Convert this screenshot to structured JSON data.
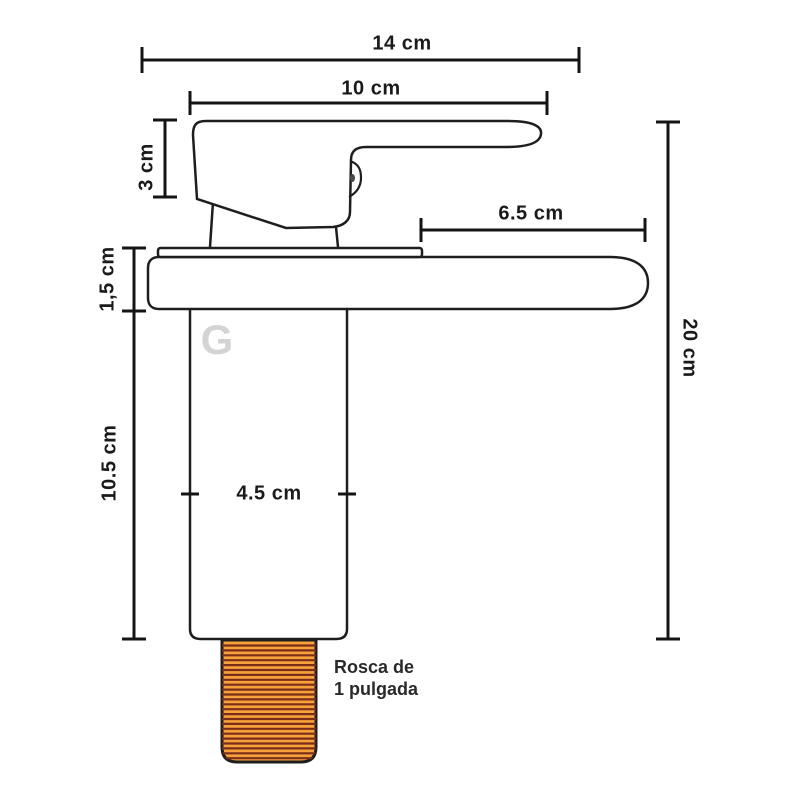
{
  "diagram": {
    "type": "technical-dimension-drawing",
    "subject": "basin faucet side view",
    "dimensions": {
      "overall_width": "14 cm",
      "handle_length": "10 cm",
      "handle_height": "3 cm",
      "spout_reach": "6.5 cm",
      "deck_thickness": "1,5 cm",
      "body_height": "10.5 cm",
      "body_width": "4.5 cm",
      "overall_height": "20 cm"
    },
    "note": {
      "line1": "Rosca de",
      "line2": "1 pulgada"
    },
    "logo": {
      "text": "G"
    },
    "colors": {
      "background": "#ffffff",
      "line": "#1e1e1e",
      "thread_fill": "#f7a13a",
      "thread_stripe": "#7a2d18",
      "logo_gray": "#d4d4d4",
      "text": "#1a1a1a"
    }
  }
}
